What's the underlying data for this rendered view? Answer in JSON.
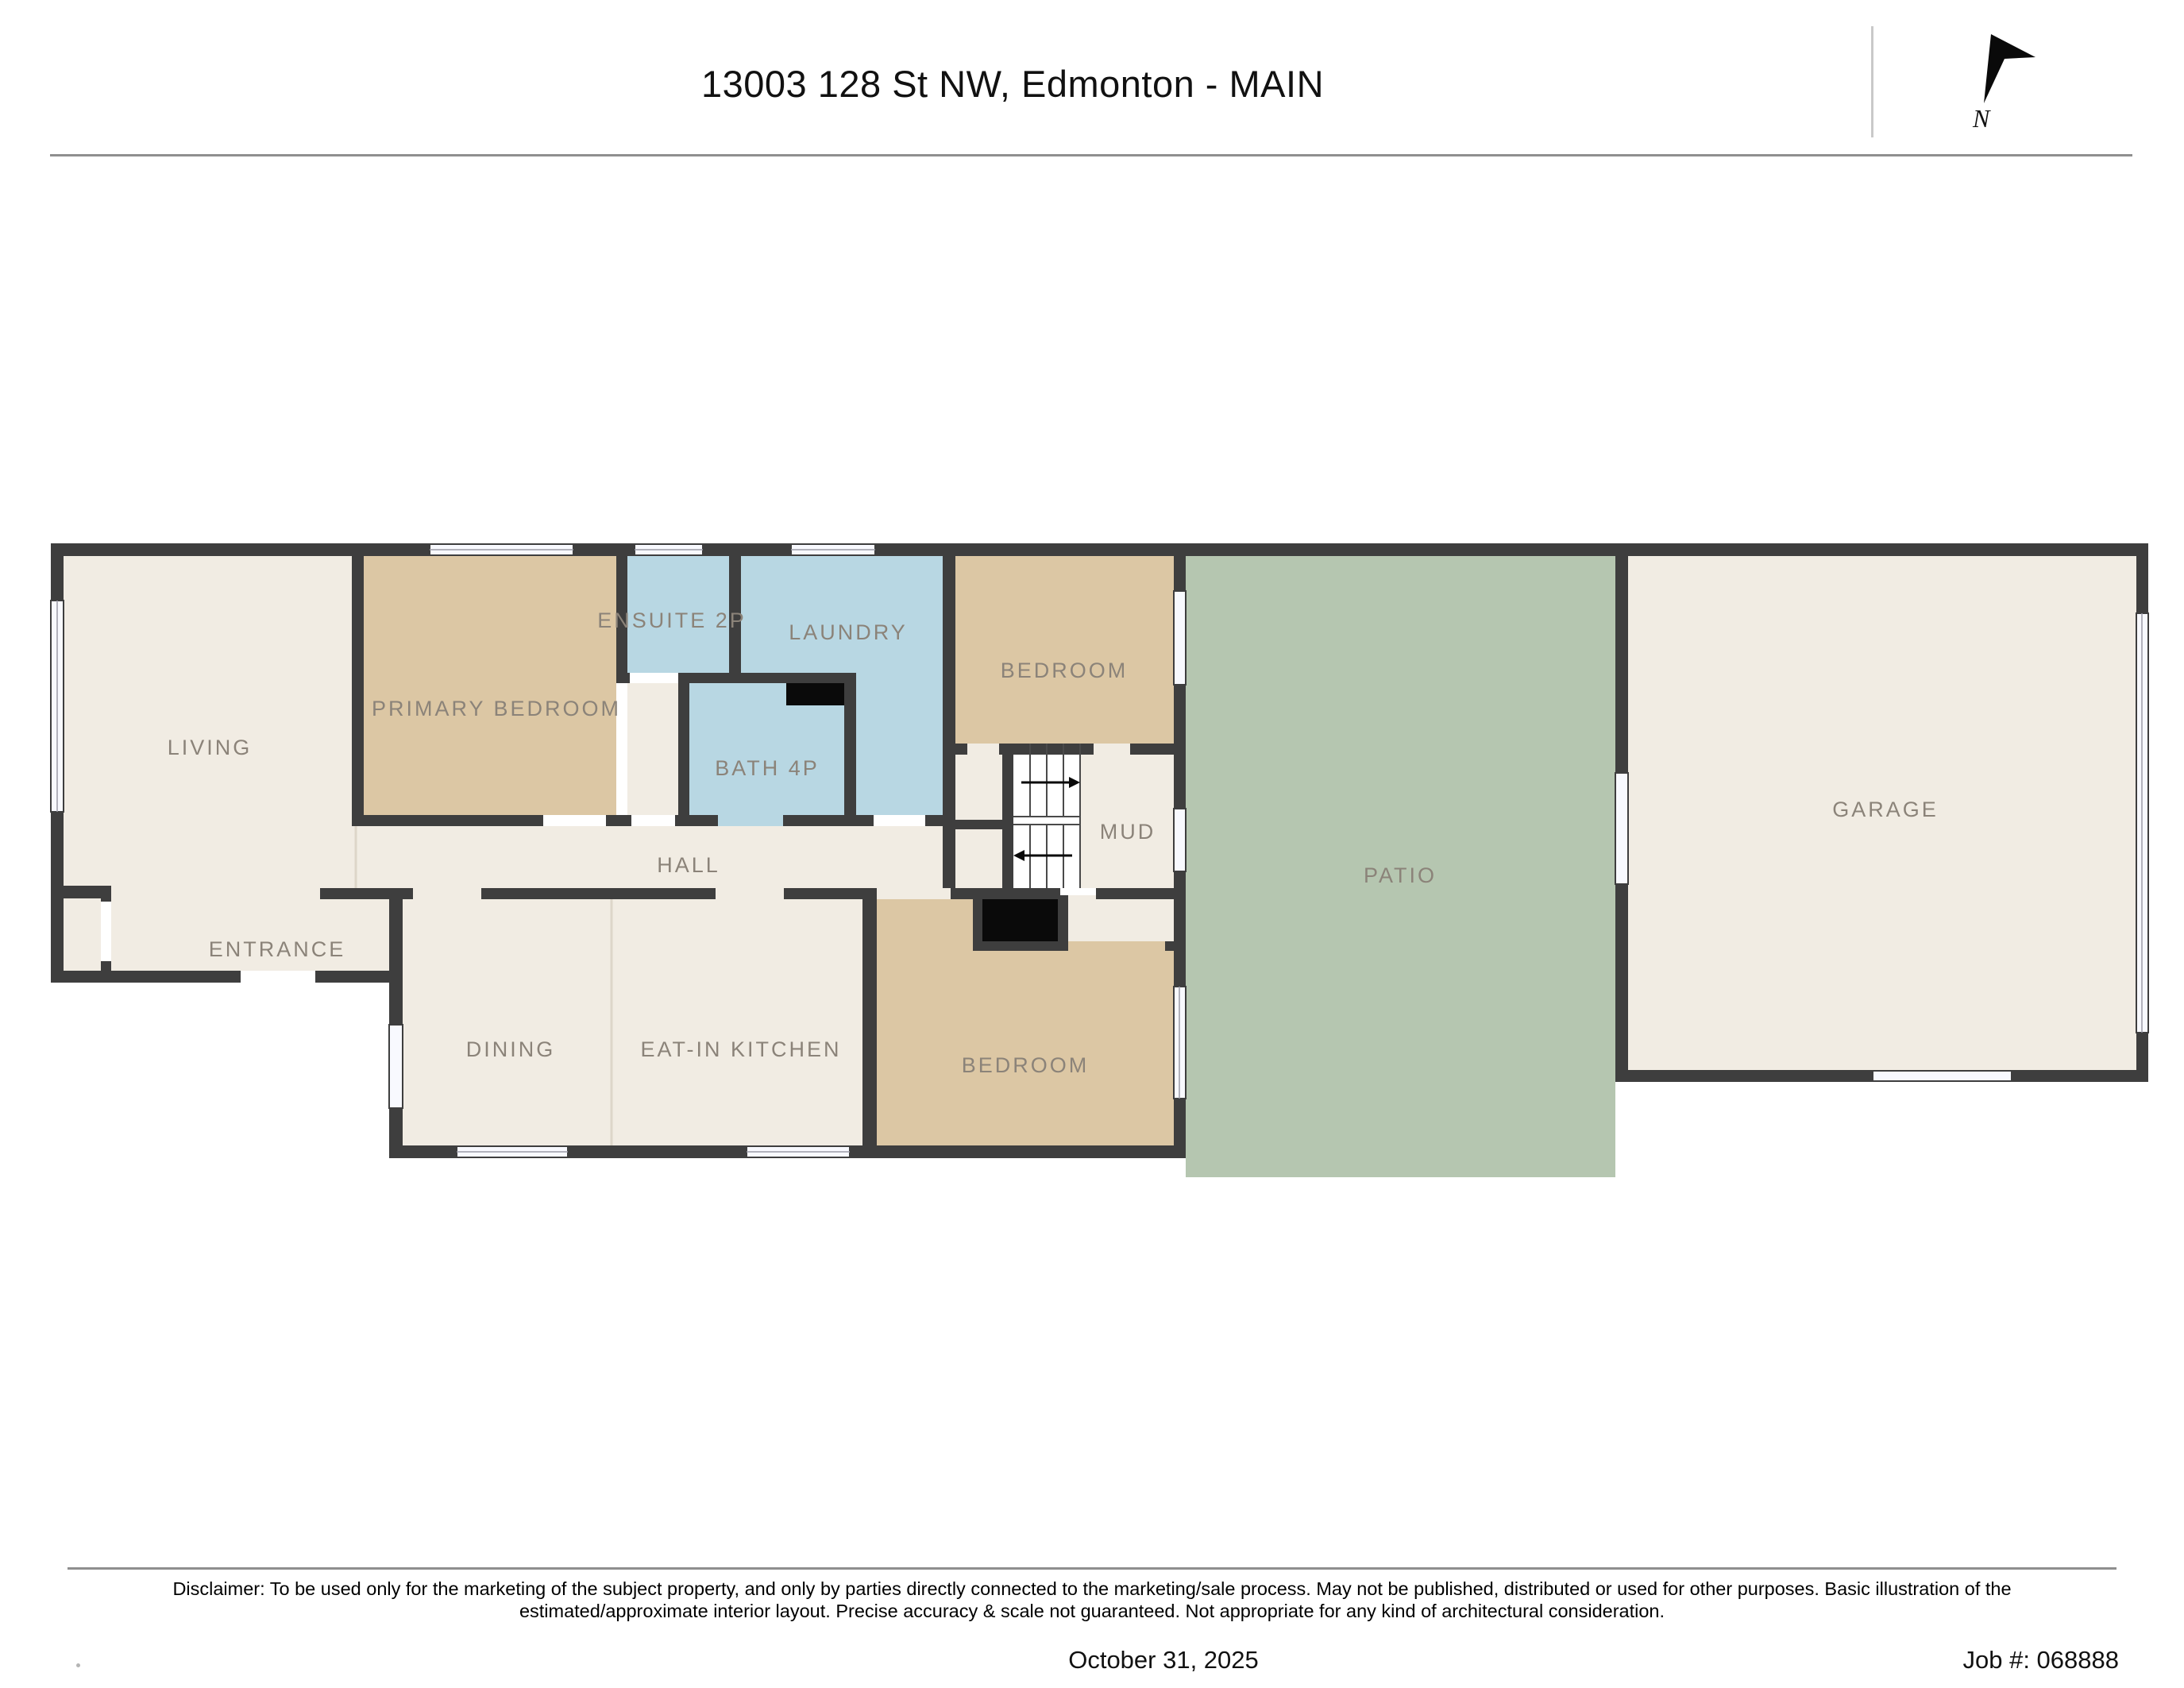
{
  "header": {
    "title": "13003 128 St NW, Edmonton - MAIN"
  },
  "compass": {
    "label": "N"
  },
  "rooms": {
    "living": "LIVING",
    "primary_bedroom": "PRIMARY BEDROOM",
    "ensuite": "ENSUITE 2P",
    "laundry": "LAUNDRY",
    "bedroom_top": "BEDROOM",
    "bath": "BATH 4P",
    "mud": "MUD",
    "hall": "HALL",
    "entrance": "ENTRANCE",
    "dining": "DINING",
    "kitchen": "EAT-IN KITCHEN",
    "bedroom_lower": "BEDROOM",
    "patio": "PATIO",
    "garage": "GARAGE"
  },
  "footer": {
    "disclaimer_line1": "Disclaimer: To be used only for the marketing of the subject property, and only by parties directly connected to the marketing/sale process. May not be published, distributed or used for other purposes. Basic illustration of the",
    "disclaimer_line2": "estimated/approximate interior layout. Precise accuracy & scale not guaranteed. Not appropriate for any kind of architectural consideration.",
    "date": "October 31, 2025",
    "job": "Job #: 068888"
  },
  "colors": {
    "wall": "#3e3e3e",
    "room_cream": "#f1ece3",
    "room_tan": "#dcc7a4",
    "room_blue": "#b8d7e3",
    "patio_green": "#b5c6b0",
    "window_fill": "#f8f9fe",
    "label": "#8b8379",
    "divider": "#8f8f8f",
    "text": "#111111"
  }
}
